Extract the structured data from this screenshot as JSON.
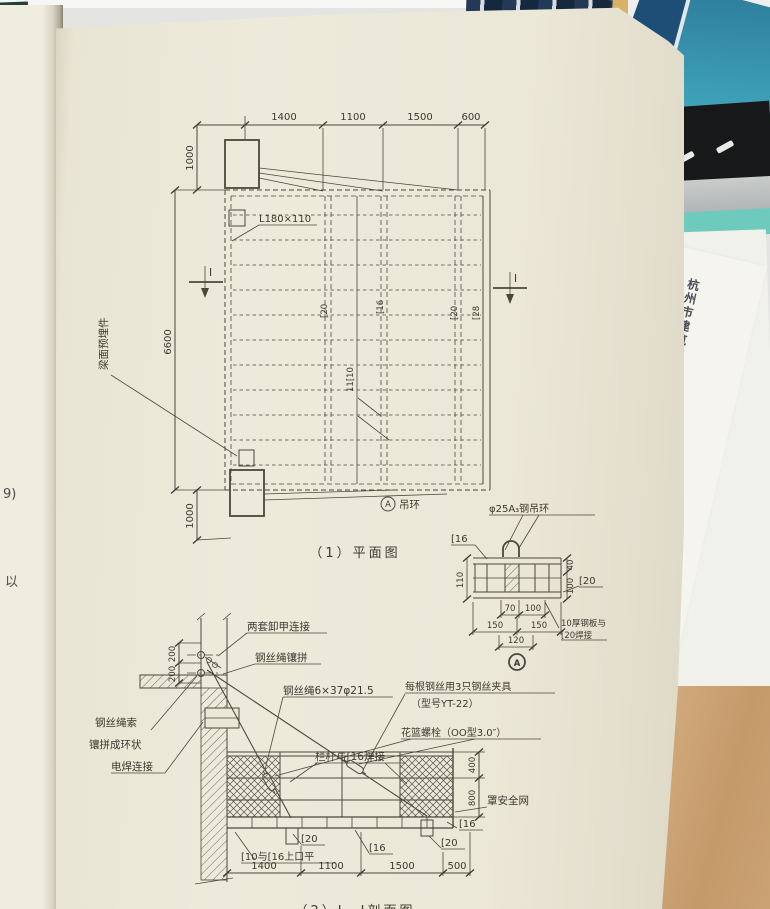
{
  "colors": {
    "page_cream": "#ece8d8",
    "left_page": "#efece0",
    "drawing_line": "#4a473d",
    "desk_wood": "#c9a172",
    "teal_book": "#3fa9c0",
    "navy_book": "#223a56",
    "teal_strip": "#6fcabe",
    "red_mark": "#c6392b"
  },
  "left_page": {
    "frag_top": "9)",
    "frag_bottom": "以"
  },
  "side_paper": {
    "title": "杭州市建筑施工现场安全文明施工标准化图册",
    "subtitle": "与建筑施工安全检查标准（JGJ59-2011）配套使用"
  },
  "plan": {
    "caption": "（1）平面图",
    "dims_top": [
      "1400",
      "1100",
      "1500",
      "600"
    ],
    "dim_left_top": "1000",
    "dim_height": "6600",
    "dim_left_bottom": "1000",
    "channel_1": "[20",
    "channel_2": "[16",
    "channel_3": "[20",
    "channel_4": "[28",
    "joists": "11[10",
    "angle": "L180×110",
    "embedded": "梁面预埋件",
    "mark_left": "Ⅰ",
    "mark_right": "Ⅰ",
    "ring_ref": "A",
    "ring_label": "吊环"
  },
  "detail_a": {
    "ref": "A",
    "ring": "φ25A₃钢吊环",
    "c16": "[16",
    "c20": "[20",
    "plate_1": "10厚钢板与",
    "plate_2": "[20焊接",
    "dim_110": "110",
    "dim_40": "40",
    "dim_100_right": "100",
    "dim_70": "70",
    "dim_100": "100",
    "dim_150_a": "150",
    "dim_150_b": "150",
    "dim_120": "120"
  },
  "section": {
    "caption": "（2）Ⅰ—Ⅰ剖面图",
    "shackle": "两套卸甲连接",
    "rope_splice": "钢丝绳镶拼",
    "rope_spec": "钢丝绳6×37φ21.5",
    "clamps_1": "每根钢丝用3只钢丝夹具",
    "clamps_2": "（型号YT-22）",
    "turnbuckle": "花篮螺栓（OO型3.0″）",
    "rail_weld": "栏杆与[16焊接",
    "rope_ring_1": "钢丝绳索",
    "rope_ring_2": "镶拼成环状",
    "weld": "电焊连接",
    "flush": "[10与[16上口平",
    "net": "罩安全网",
    "c20_mid": "[20",
    "c16_mid": "[16",
    "c16_end": "[16",
    "c20_end": "[20",
    "dim_200_a": "200",
    "dim_200_b": "200",
    "dim_400": "400",
    "dim_800": "800",
    "dims_bottom": [
      "1400",
      "1100",
      "1500",
      "500"
    ]
  }
}
